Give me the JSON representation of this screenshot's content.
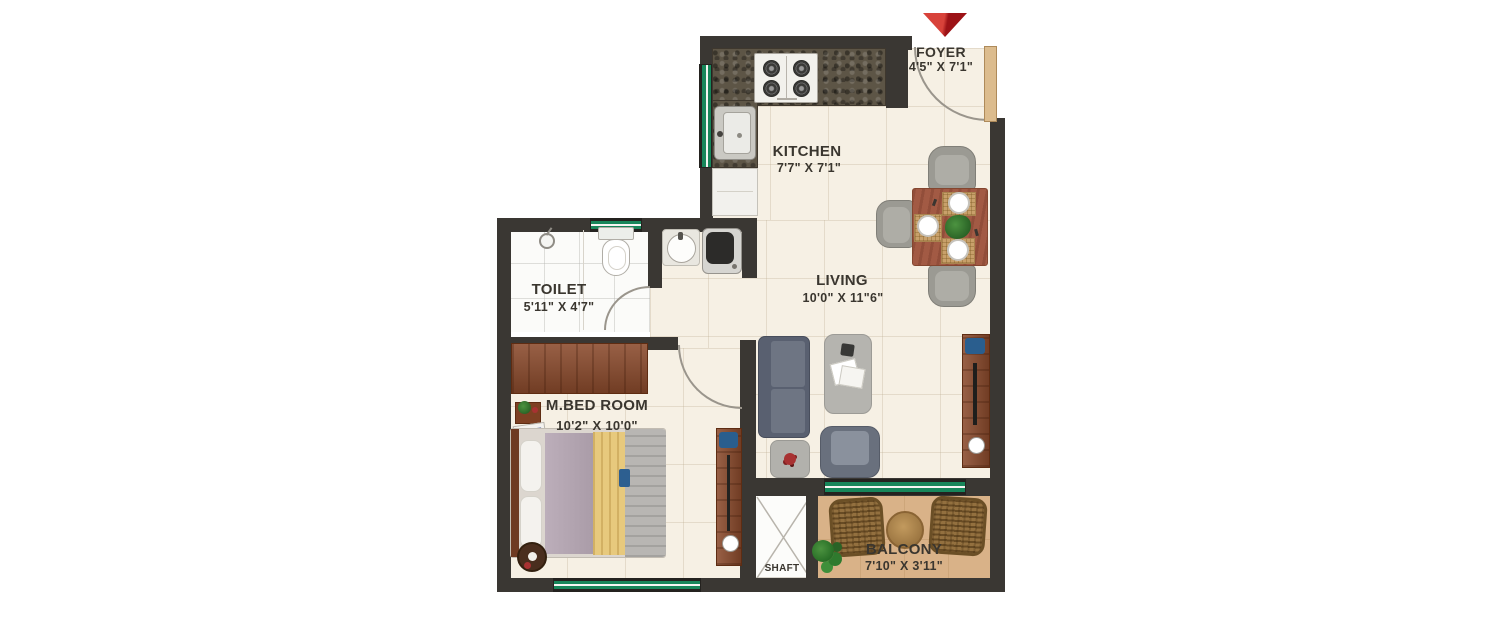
{
  "rooms": {
    "foyer": {
      "name": "FOYER",
      "dims": "4'5\" X 7'1\""
    },
    "kitchen": {
      "name": "KITCHEN",
      "dims": "7'7\" X 7'1\""
    },
    "toilet": {
      "name": "TOILET",
      "dims": "5'11\" X 4'7\""
    },
    "living": {
      "name": "LIVING",
      "dims": "10'0\" X 11\"6\""
    },
    "bedroom": {
      "name": "M.BED ROOM",
      "dims": "10'2\" X 10'0\""
    },
    "balcony": {
      "name": "BALCONY",
      "dims": "7'10\" X 3'11\""
    },
    "shaft": {
      "name": "SHAFT"
    }
  },
  "entry": {
    "marker": "entry-arrow"
  },
  "colors": {
    "wall": "#3a3733",
    "floor_tile": "#f6f0e4",
    "toilet_floor": "#fbfbf9",
    "balcony_floor": "#d9b288",
    "window_green": "#17865a",
    "wood_brown": "#8a4a2c",
    "label_text": "#3a362f",
    "entry_arrow_red": "#c8232b"
  }
}
